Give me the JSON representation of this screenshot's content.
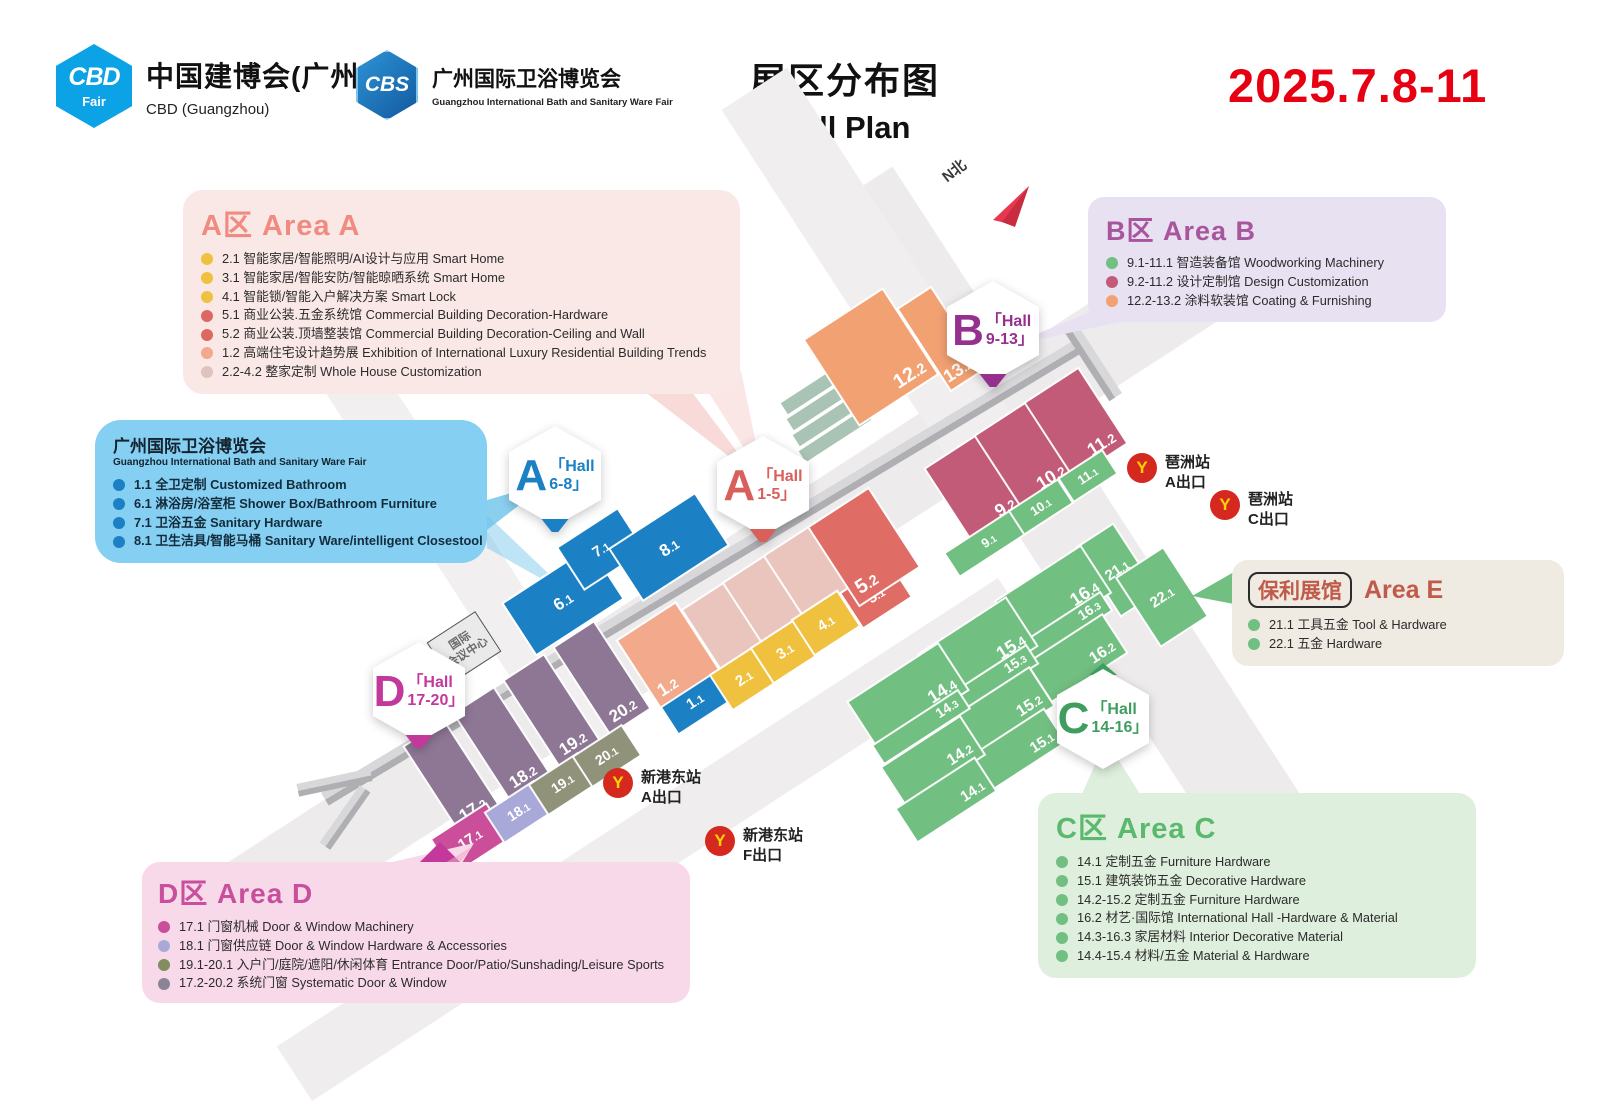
{
  "header": {
    "cbd_logo": {
      "abbr": "CBD",
      "tag": "Fair",
      "title": "中国建博会(广州)",
      "subtitle": "CBD (Guangzhou)"
    },
    "cbs_logo": {
      "abbr": "CBS",
      "title": "广州国际卫浴博览会",
      "subtitle": "Guangzhou International Bath and Sanitary Ware Fair"
    },
    "title_cn": "展区分布图",
    "title_en": "Hall Plan",
    "date": "2025.7.8-11",
    "date_color": "#E60012"
  },
  "legends": [
    {
      "id": "area-a",
      "title_prefix": "A区",
      "title": "Area A",
      "color": "#EF8B80",
      "bg": "#FAE8E6",
      "items": [
        {
          "dot": "#F0C13F",
          "text": "2.1 智能家居/智能照明/AI设计与应用 Smart Home"
        },
        {
          "dot": "#F0C13F",
          "text": "3.1 智能家居/智能安防/智能晾晒系统 Smart Home"
        },
        {
          "dot": "#F0C13F",
          "text": "4.1 智能锁/智能入户解决方案 Smart Lock"
        },
        {
          "dot": "#DD6862",
          "text": "5.1 商业公装.五金系统馆 Commercial Building Decoration-Hardware"
        },
        {
          "dot": "#DD6862",
          "text": "5.2 商业公装.顶墙整装馆 Commercial Building Decoration-Ceiling and Wall"
        },
        {
          "dot": "#F2A98C",
          "text": "1.2 高端住宅设计趋势展 Exhibition of International Luxury Residential Building Trends"
        },
        {
          "dot": "#DFC3BF",
          "text": "2.2-4.2 整家定制 Whole House Customization"
        }
      ]
    },
    {
      "id": "bath",
      "title": "广州国际卫浴博览会",
      "subtitle": "Guangzhou International Bath and Sanitary Ware Fair",
      "bg": "#85CFF2",
      "items": [
        {
          "dot": "#1B80C4",
          "text": "1.1 全卫定制 Customized Bathroom"
        },
        {
          "dot": "#1B80C4",
          "text": "6.1 淋浴房/浴室柜 Shower Box/Bathroom Furniture"
        },
        {
          "dot": "#1B80C4",
          "text": "7.1 卫浴五金 Sanitary Hardware"
        },
        {
          "dot": "#1B80C4",
          "text": "8.1 卫生洁具/智能马桶 Sanitary Ware/intelligent Closestool"
        }
      ]
    },
    {
      "id": "area-b",
      "title_prefix": "B区",
      "title": "Area B",
      "color": "#A8559E",
      "bg": "#E8E1F1",
      "items": [
        {
          "dot": "#72BF82",
          "text": "9.1-11.1 智造装备馆 Woodworking Machinery"
        },
        {
          "dot": "#C25B78",
          "text": "9.2-11.2 设计定制馆 Design Customization"
        },
        {
          "dot": "#F2A172",
          "text": "12.2-13.2 涂料软装馆 Coating & Furnishing"
        }
      ]
    },
    {
      "id": "area-e",
      "badge": "保利展馆",
      "title": "Area E",
      "color": "#C05A49",
      "bg": "#EFEAE2",
      "items": [
        {
          "dot": "#72BF82",
          "text": "21.1 工具五金 Tool & Hardware"
        },
        {
          "dot": "#72BF82",
          "text": "22.1 五金 Hardware"
        }
      ]
    },
    {
      "id": "area-c",
      "title_prefix": "C区",
      "title": "Area C",
      "color": "#5BB96D",
      "bg": "#DFEFDD",
      "items": [
        {
          "dot": "#72BF82",
          "text": "14.1 定制五金 Furniture Hardware"
        },
        {
          "dot": "#72BF82",
          "text": "15.1 建筑装饰五金 Decorative Hardware"
        },
        {
          "dot": "#72BF82",
          "text": "14.2-15.2 定制五金 Furniture Hardware"
        },
        {
          "dot": "#72BF82",
          "text": "16.2 材艺·国际馆 International Hall -Hardware & Material"
        },
        {
          "dot": "#72BF82",
          "text": "14.3-16.3 家居材料 Interior Decorative Material"
        },
        {
          "dot": "#72BF82",
          "text": "14.4-15.4 材料/五金 Material & Hardware"
        }
      ]
    },
    {
      "id": "area-d",
      "title_prefix": "D区",
      "title": "Area D",
      "color": "#C94F9D",
      "bg": "#F7D9E9",
      "items": [
        {
          "dot": "#CB4E9A",
          "text": "17.1 门窗机械 Door & Window Machinery"
        },
        {
          "dot": "#A9A9D9",
          "text": "18.1 门窗供应链 Door & Window Hardware & Accessories"
        },
        {
          "dot": "#7F8D5F",
          "text": "19.1-20.1 入户门/庭院/遮阳/休闲体育 Entrance Door/Patio/Sunshading/Leisure Sports"
        },
        {
          "dot": "#8B8494",
          "text": "17.2-20.2 系统门窗 Systematic Door & Window"
        }
      ]
    }
  ],
  "map": {
    "palette": {
      "blue": "#1B80C4",
      "salmon": "#F2A98C",
      "rose": "#EAC5BD",
      "yellow": "#F0C13F",
      "red": "#E06C66",
      "orange": "#F2A172",
      "wine": "#C25B78",
      "green": "#72BF82",
      "purple": "#8E7795",
      "magenta": "#CB4E9A",
      "lavender": "#A9A9D9",
      "olive": "#90927A"
    },
    "halls": [
      {
        "label": "6.1",
        "c": "blue",
        "x": 563,
        "y": 601,
        "w": 102,
        "h": 60,
        "fs": 17,
        "a": "c"
      },
      {
        "label": "7.1",
        "c": "blue",
        "x": 601,
        "y": 549,
        "w": 70,
        "h": 48,
        "fs": 15,
        "a": "c"
      },
      {
        "label": "8.1",
        "c": "blue",
        "x": 669,
        "y": 547,
        "w": 100,
        "h": 60,
        "fs": 17,
        "a": "c"
      },
      {
        "label": "1.1",
        "c": "blue",
        "x": 695,
        "y": 701,
        "w": 62,
        "h": 36,
        "fs": 15,
        "a": "c"
      },
      {
        "label": "1.2",
        "c": "salmon",
        "x": 668,
        "y": 655,
        "w": 68,
        "h": 78,
        "fs": 18,
        "a": "bl"
      },
      {
        "label": "2.2",
        "c": "rose",
        "x": 731,
        "y": 634,
        "w": 54,
        "h": 92,
        "fs": 19,
        "a": "bl"
      },
      {
        "label": "3.2",
        "c": "rose",
        "x": 772,
        "y": 607,
        "w": 54,
        "h": 92,
        "fs": 19,
        "a": "bl"
      },
      {
        "label": "4.2",
        "c": "rose",
        "x": 813,
        "y": 580,
        "w": 54,
        "h": 92,
        "fs": 19,
        "a": "bl"
      },
      {
        "label": "2.1",
        "c": "yellow",
        "x": 744,
        "y": 678,
        "w": 52,
        "h": 40,
        "fs": 15,
        "a": "c"
      },
      {
        "label": "3.1",
        "c": "yellow",
        "x": 785,
        "y": 651,
        "w": 52,
        "h": 40,
        "fs": 15,
        "a": "c"
      },
      {
        "label": "4.1",
        "c": "yellow",
        "x": 826,
        "y": 623,
        "w": 52,
        "h": 40,
        "fs": 15,
        "a": "c"
      },
      {
        "label": "5.1",
        "c": "red",
        "x": 876,
        "y": 595,
        "w": 56,
        "h": 40,
        "fs": 15,
        "a": "c"
      },
      {
        "label": "5.2",
        "c": "red",
        "x": 864,
        "y": 547,
        "w": 70,
        "h": 92,
        "fs": 20,
        "a": "bl"
      },
      {
        "label": "12.2",
        "c": "orange",
        "x": 871,
        "y": 357,
        "w": 92,
        "h": 100,
        "fs": 20,
        "a": "br"
      },
      {
        "label": "13.2",
        "c": "orange",
        "x": 941,
        "y": 339,
        "w": 38,
        "h": 96,
        "fs": 18,
        "a": "br"
      },
      {
        "label": "9.2",
        "c": "wine",
        "x": 976,
        "y": 489,
        "w": 62,
        "h": 88,
        "fs": 18,
        "a": "br"
      },
      {
        "label": "10.2",
        "c": "wine",
        "x": 1026,
        "y": 456,
        "w": 62,
        "h": 88,
        "fs": 18,
        "a": "br"
      },
      {
        "label": "11.2",
        "c": "wine",
        "x": 1076,
        "y": 423,
        "w": 62,
        "h": 88,
        "fs": 18,
        "a": "br"
      },
      {
        "label": "9.1",
        "c": "green",
        "x": 989,
        "y": 541,
        "w": 86,
        "h": 26,
        "fs": 13,
        "a": "c"
      },
      {
        "label": "10.1",
        "c": "green",
        "x": 1041,
        "y": 507,
        "w": 56,
        "h": 26,
        "fs": 13,
        "a": "c"
      },
      {
        "label": "11.1",
        "c": "green",
        "x": 1088,
        "y": 476,
        "w": 50,
        "h": 26,
        "fs": 13,
        "a": "c"
      },
      {
        "label": "21.1",
        "c": "green",
        "x": 1117,
        "y": 570,
        "w": 42,
        "h": 80,
        "fs": 15,
        "a": "c"
      },
      {
        "label": "22.1",
        "c": "green",
        "x": 1162,
        "y": 597,
        "w": 54,
        "h": 80,
        "fs": 15,
        "a": "c"
      },
      {
        "label": "16.4",
        "c": "green",
        "x": 1053,
        "y": 597,
        "w": 100,
        "h": 54,
        "fs": 18,
        "a": "br"
      },
      {
        "label": "16.3",
        "c": "green",
        "x": 1065,
        "y": 628,
        "w": 96,
        "h": 20,
        "fs": 14,
        "a": "br"
      },
      {
        "label": "16.2",
        "c": "green",
        "x": 1077,
        "y": 658,
        "w": 88,
        "h": 44,
        "fs": 16,
        "a": "br"
      },
      {
        "label": "15.4",
        "c": "green",
        "x": 978,
        "y": 650,
        "w": 102,
        "h": 56,
        "fs": 18,
        "a": "br"
      },
      {
        "label": "15.3",
        "c": "green",
        "x": 991,
        "y": 681,
        "w": 96,
        "h": 20,
        "fs": 14,
        "a": "br"
      },
      {
        "label": "15.2",
        "c": "green",
        "x": 1004,
        "y": 711,
        "w": 88,
        "h": 44,
        "fs": 16,
        "a": "br"
      },
      {
        "label": "15.1",
        "c": "green",
        "x": 1017,
        "y": 750,
        "w": 88,
        "h": 38,
        "fs": 15,
        "a": "br"
      },
      {
        "label": "14.4",
        "c": "green",
        "x": 908,
        "y": 696,
        "w": 106,
        "h": 54,
        "fs": 18,
        "a": "br"
      },
      {
        "label": "14.3",
        "c": "green",
        "x": 921,
        "y": 727,
        "w": 100,
        "h": 20,
        "fs": 14,
        "a": "br"
      },
      {
        "label": "14.2",
        "c": "green",
        "x": 933,
        "y": 761,
        "w": 92,
        "h": 44,
        "fs": 16,
        "a": "br"
      },
      {
        "label": "14.1",
        "c": "green",
        "x": 946,
        "y": 800,
        "w": 92,
        "h": 38,
        "fs": 15,
        "a": "br"
      },
      {
        "label": "17.2",
        "c": "purple",
        "x": 452,
        "y": 777,
        "w": 46,
        "h": 102,
        "fs": 17,
        "a": "bc"
      },
      {
        "label": "18.2",
        "c": "purple",
        "x": 502,
        "y": 744,
        "w": 46,
        "h": 102,
        "fs": 17,
        "a": "bc"
      },
      {
        "label": "19.2",
        "c": "purple",
        "x": 552,
        "y": 711,
        "w": 46,
        "h": 102,
        "fs": 17,
        "a": "bc"
      },
      {
        "label": "20.2",
        "c": "purple",
        "x": 602,
        "y": 678,
        "w": 46,
        "h": 102,
        "fs": 17,
        "a": "bc"
      },
      {
        "label": "17.1",
        "c": "magenta",
        "x": 470,
        "y": 839,
        "w": 64,
        "h": 40,
        "fs": 15,
        "a": "c"
      },
      {
        "label": "18.1",
        "c": "lavender",
        "x": 519,
        "y": 812,
        "w": 56,
        "h": 34,
        "fs": 14,
        "a": "c"
      },
      {
        "label": "19.1",
        "c": "olive",
        "x": 563,
        "y": 784,
        "w": 56,
        "h": 34,
        "fs": 14,
        "a": "c"
      },
      {
        "label": "20.1",
        "c": "olive",
        "x": 607,
        "y": 756,
        "w": 56,
        "h": 34,
        "fs": 14,
        "a": "c"
      }
    ],
    "badges": [
      {
        "letter": "A",
        "line1": "Hall",
        "line2": "6-8",
        "color": "#1B80C4",
        "x": 555,
        "y": 479,
        "tail": "down"
      },
      {
        "letter": "A",
        "line1": "Hall",
        "line2": "1-5",
        "color": "#D95F5A",
        "x": 763,
        "y": 489,
        "tail": "down"
      },
      {
        "letter": "B",
        "line1": "Hall",
        "line2": "9-13",
        "color": "#95308F",
        "x": 993,
        "y": 334,
        "tail": "down"
      },
      {
        "letter": "C",
        "line1": "Hall",
        "line2": "14-16",
        "color": "#3F9E5F",
        "x": 1103,
        "y": 716,
        "tail": "up"
      },
      {
        "letter": "D",
        "line1": "Hall",
        "line2": "17-20",
        "color": "#C2399B",
        "x": 419,
        "y": 695,
        "tail": "down"
      }
    ],
    "metro_exits": [
      {
        "station": "琶洲站",
        "exit": "A出口",
        "x": 1127,
        "y": 453
      },
      {
        "station": "琶洲站",
        "exit": "C出口",
        "x": 1210,
        "y": 490
      },
      {
        "station": "新港东站",
        "exit": "A出口",
        "x": 603,
        "y": 768
      },
      {
        "station": "新港东站",
        "exit": "F出口",
        "x": 705,
        "y": 826
      }
    ],
    "decor_strips": [
      {
        "x": 817,
        "y": 387
      },
      {
        "x": 823,
        "y": 403
      },
      {
        "x": 829,
        "y": 419
      },
      {
        "x": 835,
        "y": 435
      }
    ],
    "landmark": {
      "line1": "国际",
      "line2": "会议中心"
    },
    "north": {
      "label": "N北"
    }
  }
}
